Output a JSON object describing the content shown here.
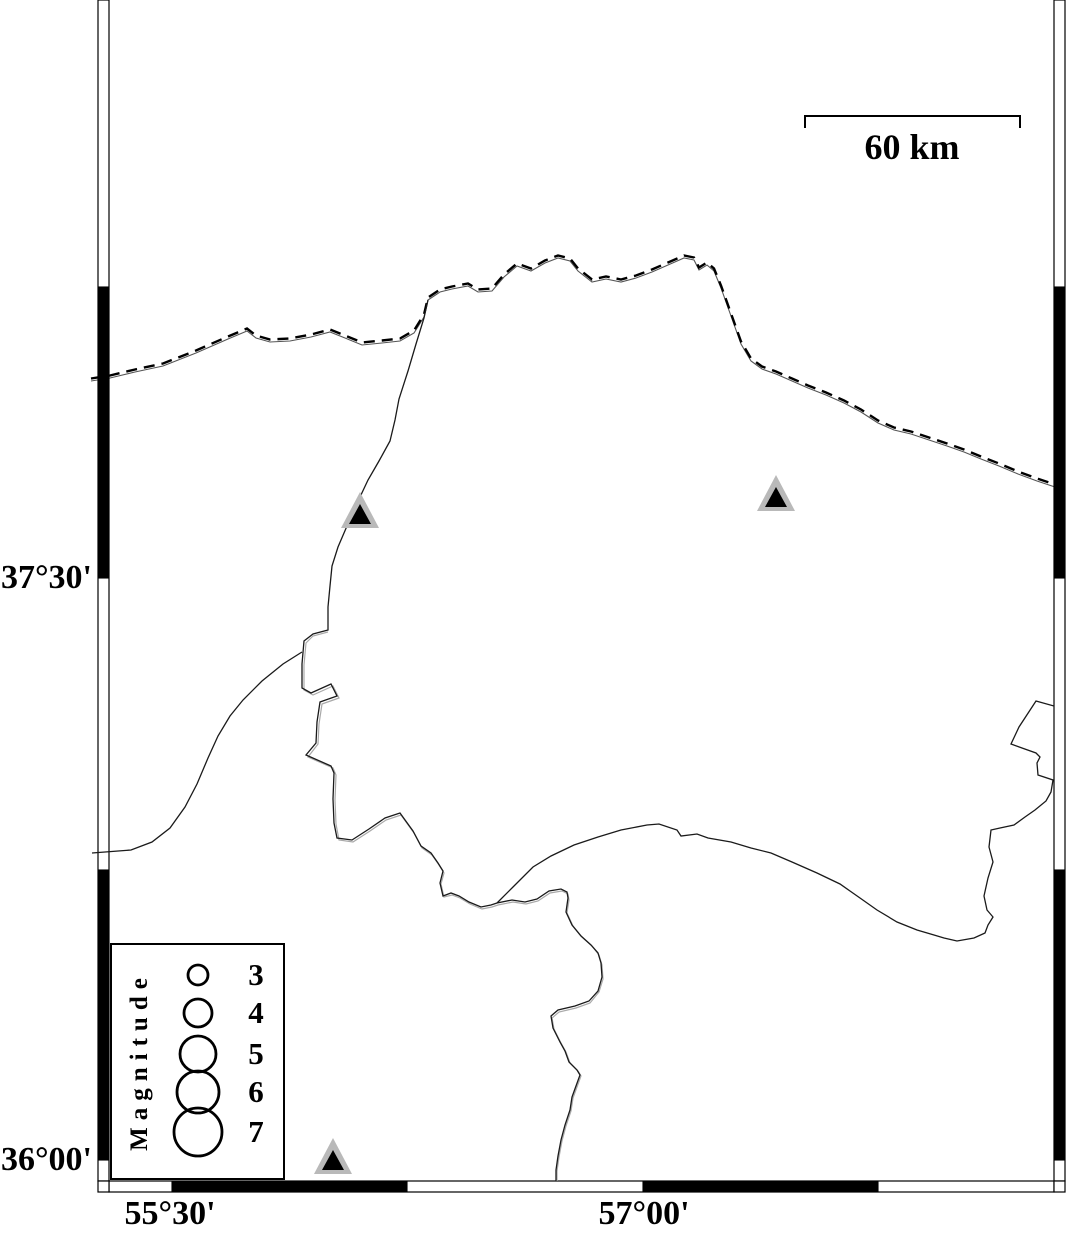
{
  "map_frame": {
    "lat_labels": [
      {
        "text": "37°30'",
        "y": 578
      },
      {
        "text": "36°00'",
        "y": 1160
      }
    ],
    "lon_labels": [
      {
        "text": "55°30'",
        "x": 172
      },
      {
        "text": "57°00'",
        "x": 643
      }
    ]
  },
  "scale_bar": {
    "label": "60 km"
  },
  "legend": {
    "title": "Magnitude",
    "entries": [
      {
        "label": "3",
        "radius": 10
      },
      {
        "label": "4",
        "radius": 14
      },
      {
        "label": "5",
        "radius": 18
      },
      {
        "label": "6",
        "radius": 21
      },
      {
        "label": "7",
        "radius": 24
      }
    ]
  },
  "stations": [
    {
      "x": 360,
      "y": 511
    },
    {
      "x": 776,
      "y": 494
    },
    {
      "x": 333,
      "y": 1157
    }
  ],
  "colors": {
    "line": "#1a1a1a",
    "border_dash": "#000000",
    "border_solid": "#555555",
    "companion_gray": "#a9a9a9",
    "station_fill": "#b9b9b9",
    "station_core": "#000000",
    "frame_black": "#000000",
    "frame_white": "#ffffff"
  }
}
